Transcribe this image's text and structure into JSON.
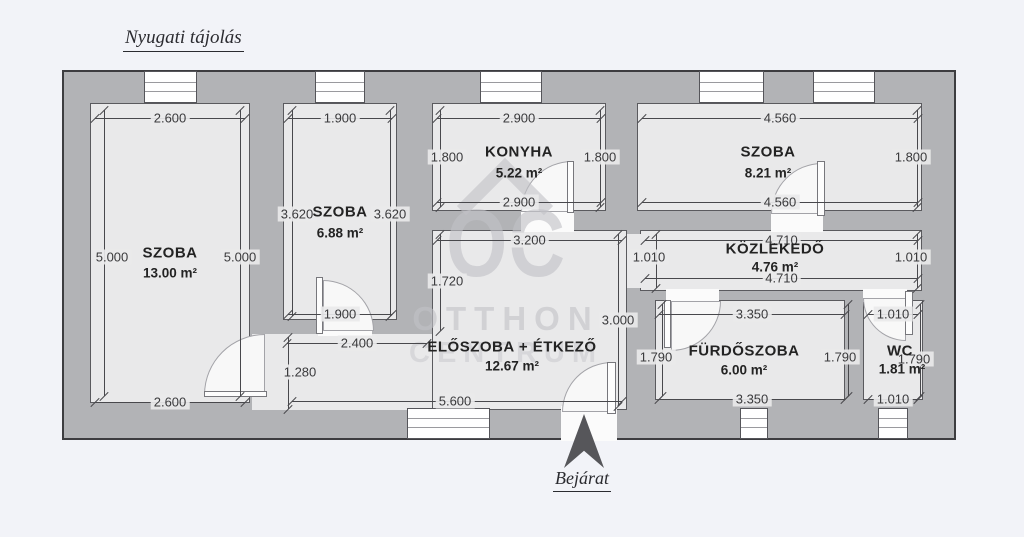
{
  "page": {
    "orientation_label": "Nyugati tájolás",
    "entrance_label": "Bejárat"
  },
  "watermark": {
    "line1": "OC",
    "line2": "OTTHON",
    "line3": "CENTRUM"
  },
  "colors": {
    "page_bg": "#f2f3f8",
    "wall_gray": "#b2b3b6",
    "floor_gray": "#e9e9ea",
    "outline": "#3d3d40",
    "dim_text": "#3a3a3c",
    "label_text": "#232323",
    "watermark_gray": "#c2c2c7",
    "arrow": "#56565a"
  },
  "plan": {
    "x": 62,
    "y": 70,
    "w": 894,
    "h": 370
  },
  "rooms": [
    {
      "name": "SZOBA",
      "area": "13.00 m²",
      "x": 90,
      "y": 103,
      "w": 160,
      "h": 300,
      "lx": 170,
      "ly": 253,
      "ax": 170,
      "ay": 273
    },
    {
      "name": "SZOBA",
      "area": "6.88 m²",
      "x": 283,
      "y": 103,
      "w": 114,
      "h": 217,
      "lx": 340,
      "ly": 212,
      "ax": 340,
      "ay": 233
    },
    {
      "name": "KONYHA",
      "area": "5.22 m²",
      "x": 432,
      "y": 103,
      "w": 174,
      "h": 108,
      "lx": 519,
      "ly": 152,
      "ax": 519,
      "ay": 173
    },
    {
      "name": "SZOBA",
      "area": "8.21 m²",
      "x": 637,
      "y": 103,
      "w": 285,
      "h": 108,
      "lx": 768,
      "ly": 152,
      "ax": 768,
      "ay": 173
    },
    {
      "name": "KÖZLEKEDŐ",
      "area": "4.76 m²",
      "x": 640,
      "y": 230,
      "w": 282,
      "h": 61,
      "lx": 775,
      "ly": 249,
      "ax": 775,
      "ay": 267
    },
    {
      "name": "ELŐSZOBA + ÉTKEZŐ",
      "area": "12.67 m²",
      "x": 432,
      "y": 230,
      "w": 195,
      "h": 180,
      "lx": 512,
      "ly": 347,
      "ax": 512,
      "ay": 366
    },
    {
      "name": "FÜRDŐSZOBA",
      "area": "6.00 m²",
      "x": 655,
      "y": 300,
      "w": 190,
      "h": 100,
      "lx": 744,
      "ly": 351,
      "ax": 744,
      "ay": 370
    },
    {
      "name": "WC",
      "area": "1.81 m²",
      "x": 863,
      "y": 300,
      "w": 60,
      "h": 100,
      "lx": 900,
      "ly": 351,
      "ax": 902,
      "ay": 369
    }
  ],
  "floor_patches": [
    {
      "x": 252,
      "y": 334,
      "w": 180,
      "h": 76
    },
    {
      "x": 627,
      "y": 234,
      "w": 14,
      "h": 54
    }
  ],
  "wall_openings": [
    {
      "x": 318,
      "y": 318,
      "w": 54,
      "h": 18
    },
    {
      "x": 521,
      "y": 209,
      "w": 53,
      "h": 23
    },
    {
      "x": 771,
      "y": 209,
      "w": 52,
      "h": 23
    },
    {
      "x": 666,
      "y": 289,
      "w": 53,
      "h": 13
    },
    {
      "x": 863,
      "y": 289,
      "w": 44,
      "h": 13
    },
    {
      "x": 561,
      "y": 406,
      "w": 56,
      "h": 35
    }
  ],
  "door_arcs": [
    {
      "x": 204,
      "y": 334,
      "s": 61,
      "corner": "tl"
    },
    {
      "x": 323,
      "y": 280,
      "s": 51,
      "corner": "tr"
    },
    {
      "x": 521,
      "y": 161,
      "s": 51,
      "corner": "tl"
    },
    {
      "x": 771,
      "y": 163,
      "s": 51,
      "corner": "tl"
    },
    {
      "x": 671,
      "y": 301,
      "s": 50,
      "corner": "br"
    },
    {
      "x": 863,
      "y": 298,
      "s": 43,
      "corner": "bl"
    },
    {
      "x": 562,
      "y": 362,
      "s": 50,
      "corner": "tl"
    }
  ],
  "door_leaves": [
    {
      "x": 204,
      "y": 391,
      "w": 63,
      "h": 6
    },
    {
      "x": 316,
      "y": 277,
      "w": 7,
      "h": 57
    },
    {
      "x": 567,
      "y": 161,
      "w": 7,
      "h": 52
    },
    {
      "x": 817,
      "y": 161,
      "w": 8,
      "h": 55
    },
    {
      "x": 664,
      "y": 300,
      "w": 7,
      "h": 48
    },
    {
      "x": 905,
      "y": 291,
      "w": 8,
      "h": 44
    },
    {
      "x": 607,
      "y": 362,
      "w": 9,
      "h": 52
    }
  ],
  "windows": [
    {
      "x": 144,
      "y": 71,
      "w": 53,
      "h": 32
    },
    {
      "x": 315,
      "y": 71,
      "w": 50,
      "h": 32
    },
    {
      "x": 480,
      "y": 71,
      "w": 62,
      "h": 32
    },
    {
      "x": 699,
      "y": 71,
      "w": 65,
      "h": 32
    },
    {
      "x": 813,
      "y": 71,
      "w": 62,
      "h": 32
    },
    {
      "x": 407,
      "y": 408,
      "w": 83,
      "h": 31
    },
    {
      "x": 740,
      "y": 408,
      "w": 28,
      "h": 31
    },
    {
      "x": 878,
      "y": 408,
      "w": 30,
      "h": 31
    }
  ],
  "dims": [
    {
      "label": "2.600",
      "o": "h",
      "x": 95,
      "y": 118,
      "len": 150
    },
    {
      "label": "1.900",
      "o": "h",
      "x": 288,
      "y": 118,
      "len": 104
    },
    {
      "label": "2.900",
      "o": "h",
      "x": 437,
      "y": 118,
      "len": 164
    },
    {
      "label": "4.560",
      "o": "h",
      "x": 642,
      "y": 118,
      "len": 276
    },
    {
      "label": "2.900",
      "o": "h",
      "x": 437,
      "y": 202,
      "len": 164
    },
    {
      "label": "4.560",
      "o": "h",
      "x": 642,
      "y": 202,
      "len": 276
    },
    {
      "label": "3.200",
      "o": "h",
      "x": 437,
      "y": 240,
      "len": 185
    },
    {
      "label": "4.710",
      "o": "h",
      "x": 645,
      "y": 240,
      "len": 273
    },
    {
      "label": "4.710",
      "o": "h",
      "x": 645,
      "y": 278,
      "len": 273
    },
    {
      "label": "1.900",
      "o": "h",
      "x": 288,
      "y": 314,
      "len": 104
    },
    {
      "label": "2.400",
      "o": "h",
      "x": 287,
      "y": 343,
      "len": 140
    },
    {
      "label": "3.350",
      "o": "h",
      "x": 659,
      "y": 314,
      "len": 186
    },
    {
      "label": "1.010",
      "o": "h",
      "x": 868,
      "y": 314,
      "len": 50
    },
    {
      "label": "3.350",
      "o": "h",
      "x": 659,
      "y": 399,
      "len": 186
    },
    {
      "label": "1.010",
      "o": "h",
      "x": 868,
      "y": 399,
      "len": 50
    },
    {
      "label": "2.600",
      "o": "h",
      "x": 95,
      "y": 402,
      "len": 150
    },
    {
      "label": "5.600",
      "o": "h",
      "x": 292,
      "y": 401,
      "len": 330,
      "tx": 455
    },
    {
      "label": "5.000",
      "o": "v",
      "x": 104,
      "y": 110,
      "len": 286,
      "tx": 112,
      "ty": 257
    },
    {
      "label": "5.000",
      "o": "v",
      "x": 240,
      "y": 110,
      "len": 286,
      "ty": 257
    },
    {
      "label": "3.620",
      "o": "v",
      "x": 292,
      "y": 110,
      "len": 206,
      "tx": 297,
      "ty": 214
    },
    {
      "label": "3.620",
      "o": "v",
      "x": 390,
      "y": 110,
      "len": 206,
      "ty": 214
    },
    {
      "label": "1.800",
      "o": "v",
      "x": 440,
      "y": 110,
      "len": 97,
      "tx": 447,
      "ty": 157
    },
    {
      "label": "1.800",
      "o": "v",
      "x": 600,
      "y": 110,
      "len": 97,
      "ty": 157
    },
    {
      "label": "1.800",
      "o": "v",
      "x": 917,
      "y": 110,
      "len": 97,
      "tx": 911,
      "ty": 157
    },
    {
      "label": "1.720",
      "o": "v",
      "x": 440,
      "y": 234,
      "len": 97,
      "tx": 447,
      "ty": 281
    },
    {
      "label": "1.010",
      "o": "v",
      "x": 656,
      "y": 234,
      "len": 54,
      "tx": 649,
      "ty": 257
    },
    {
      "label": "1.010",
      "o": "v",
      "x": 917,
      "y": 234,
      "len": 54,
      "tx": 911,
      "ty": 257
    },
    {
      "label": "3.000",
      "o": "v",
      "x": 618,
      "y": 234,
      "len": 172,
      "ty": 320
    },
    {
      "label": "1.790",
      "o": "v",
      "x": 662,
      "y": 304,
      "len": 92,
      "tx": 656,
      "ty": 357
    },
    {
      "label": "1.790",
      "o": "v",
      "x": 848,
      "y": 304,
      "len": 92,
      "tx": 840,
      "ty": 357
    },
    {
      "label": "1.790",
      "o": "v",
      "x": 920,
      "y": 304,
      "len": 92,
      "tx": 914,
      "ty": 359
    },
    {
      "label": "1.280",
      "o": "v",
      "x": 288,
      "y": 337,
      "len": 72,
      "tx": 300,
      "ty": 372
    }
  ]
}
